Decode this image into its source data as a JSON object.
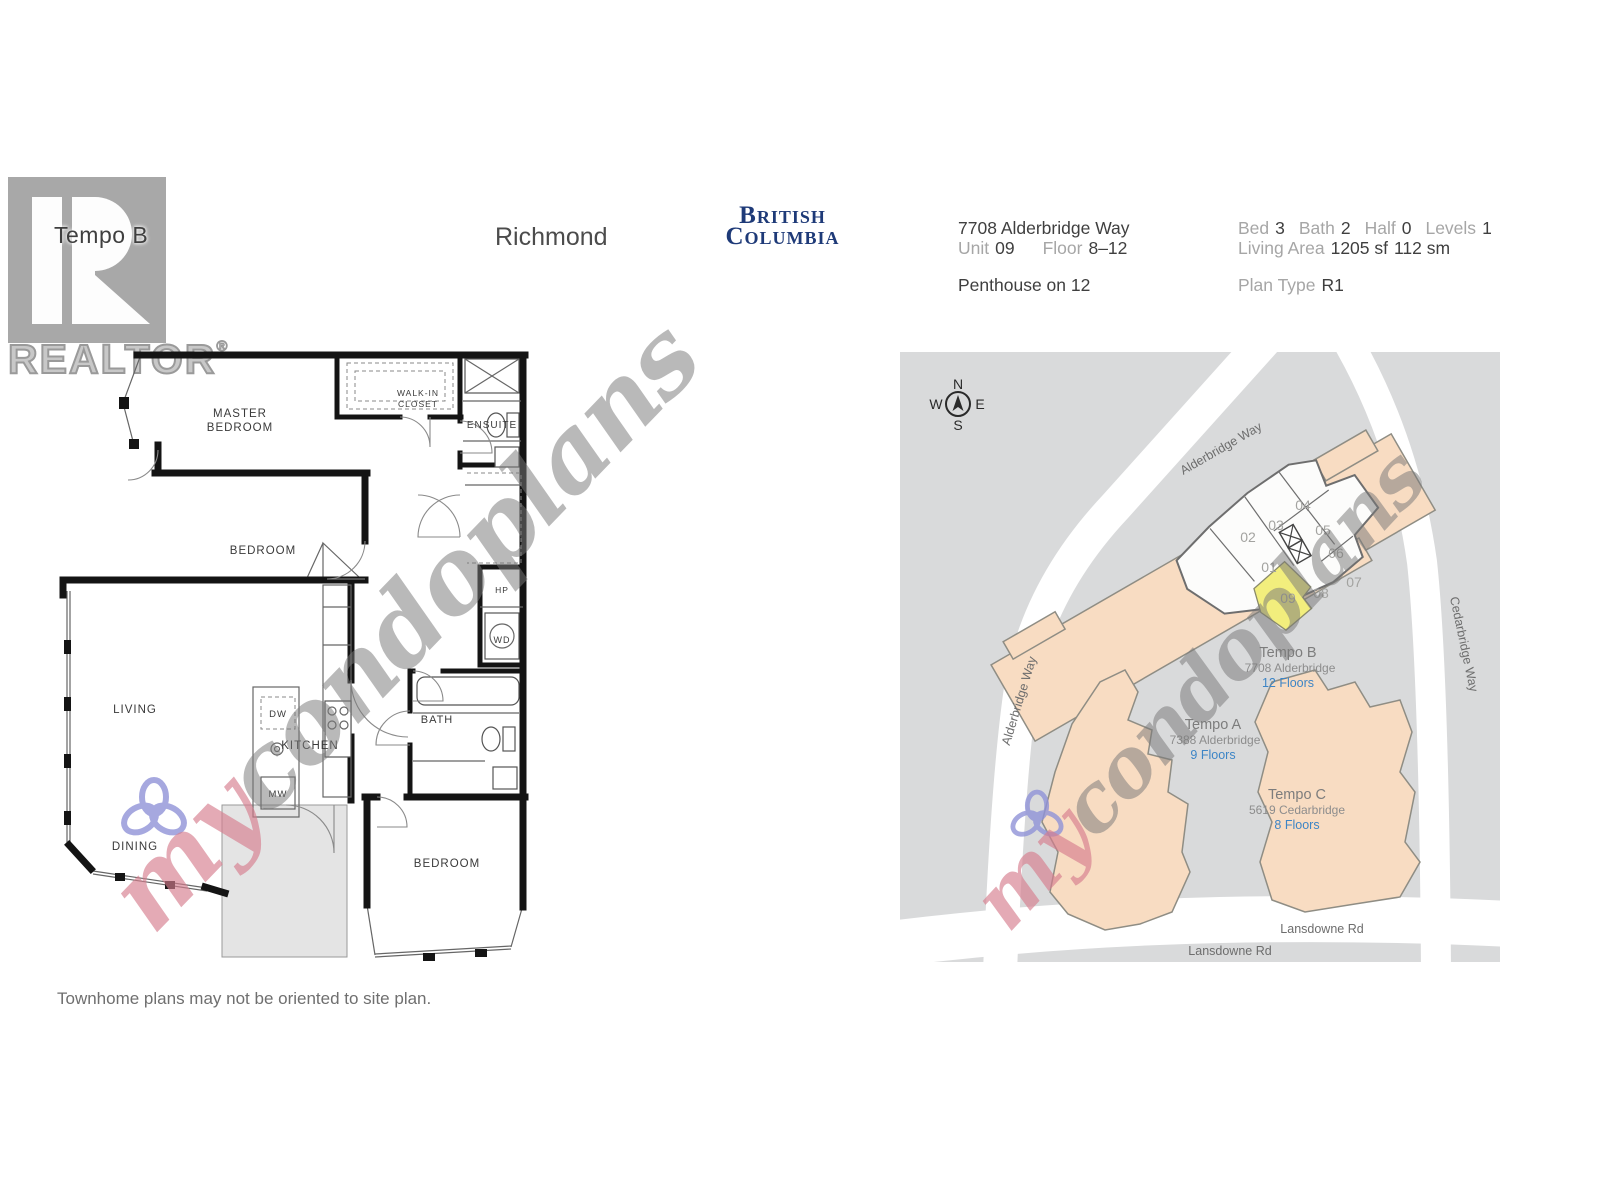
{
  "logo": {
    "tempo": "Tempo B",
    "realtor": "REALTOR",
    "reg": "®"
  },
  "header": {
    "city": "Richmond",
    "province_line1": "British",
    "province_line2": "Columbia"
  },
  "details": {
    "address": "7708 Alderbridge Way",
    "unit_label": "Unit",
    "unit_value": "09",
    "floor_label": "Floor",
    "floor_value": "8–12",
    "penthouse_note": "Penthouse on 12",
    "bed_label": "Bed",
    "bed_value": "3",
    "bath_label": "Bath",
    "bath_value": "2",
    "half_label": "Half",
    "half_value": "0",
    "levels_label": "Levels",
    "levels_value": "1",
    "living_area_label": "Living Area",
    "living_area_sf": "1205 sf",
    "living_area_sm": "112 sm",
    "plan_type_label": "Plan Type",
    "plan_type_value": "R1"
  },
  "floor_plan": {
    "rooms": {
      "master_line1": "MASTER",
      "master_line2": "BEDROOM",
      "walkin_line1": "WALK-IN",
      "walkin_line2": "CLOSET",
      "ensuite": "ENSUITE",
      "bedroom_mid": "BEDROOM",
      "living": "LIVING",
      "kitchen": "KITCHEN",
      "bath": "BATH",
      "dining": "DINING",
      "bedroom_bottom": "BEDROOM",
      "hp": "HP",
      "wd": "WD",
      "dw": "DW",
      "mw": "MW"
    }
  },
  "site_map": {
    "compass": {
      "n": "N",
      "e": "E",
      "s": "S",
      "w": "W"
    },
    "roads": {
      "alderbridge": "Alderbridge Way",
      "cedarbridge": "Cedarbridge Way",
      "lansdowne": "Lansdowne Rd"
    },
    "buildings": {
      "tempo_b": {
        "name": "Tempo B",
        "address": "7708 Alderbridge",
        "floors": "12 Floors"
      },
      "tempo_a": {
        "name": "Tempo A",
        "address": "7388 Alderbridge",
        "floors": "9 Floors"
      },
      "tempo_c": {
        "name": "Tempo C",
        "address": "5619 Cedarbridge",
        "floors": "8 Floors"
      }
    },
    "units": [
      "01",
      "02",
      "03",
      "04",
      "05",
      "06",
      "07",
      "08",
      "09"
    ],
    "highlighted_unit": "09"
  },
  "watermark": {
    "prefix": "my",
    "suffix": "condoplans"
  },
  "footer": {
    "note": "Townhome plans may not be oriented to site plan."
  },
  "colors": {
    "map_background": "#d9dadb",
    "road": "#ffffff",
    "building_fill": "#f8dcc2",
    "building_outline": "#8f8d84",
    "highlight_unit": "#f2ee7d",
    "floors_link_blue": "#3d85c6",
    "province_navy": "#1e3a78",
    "logo_gray": "#a8a8a8",
    "watermark_pink": "#d67d8e"
  }
}
